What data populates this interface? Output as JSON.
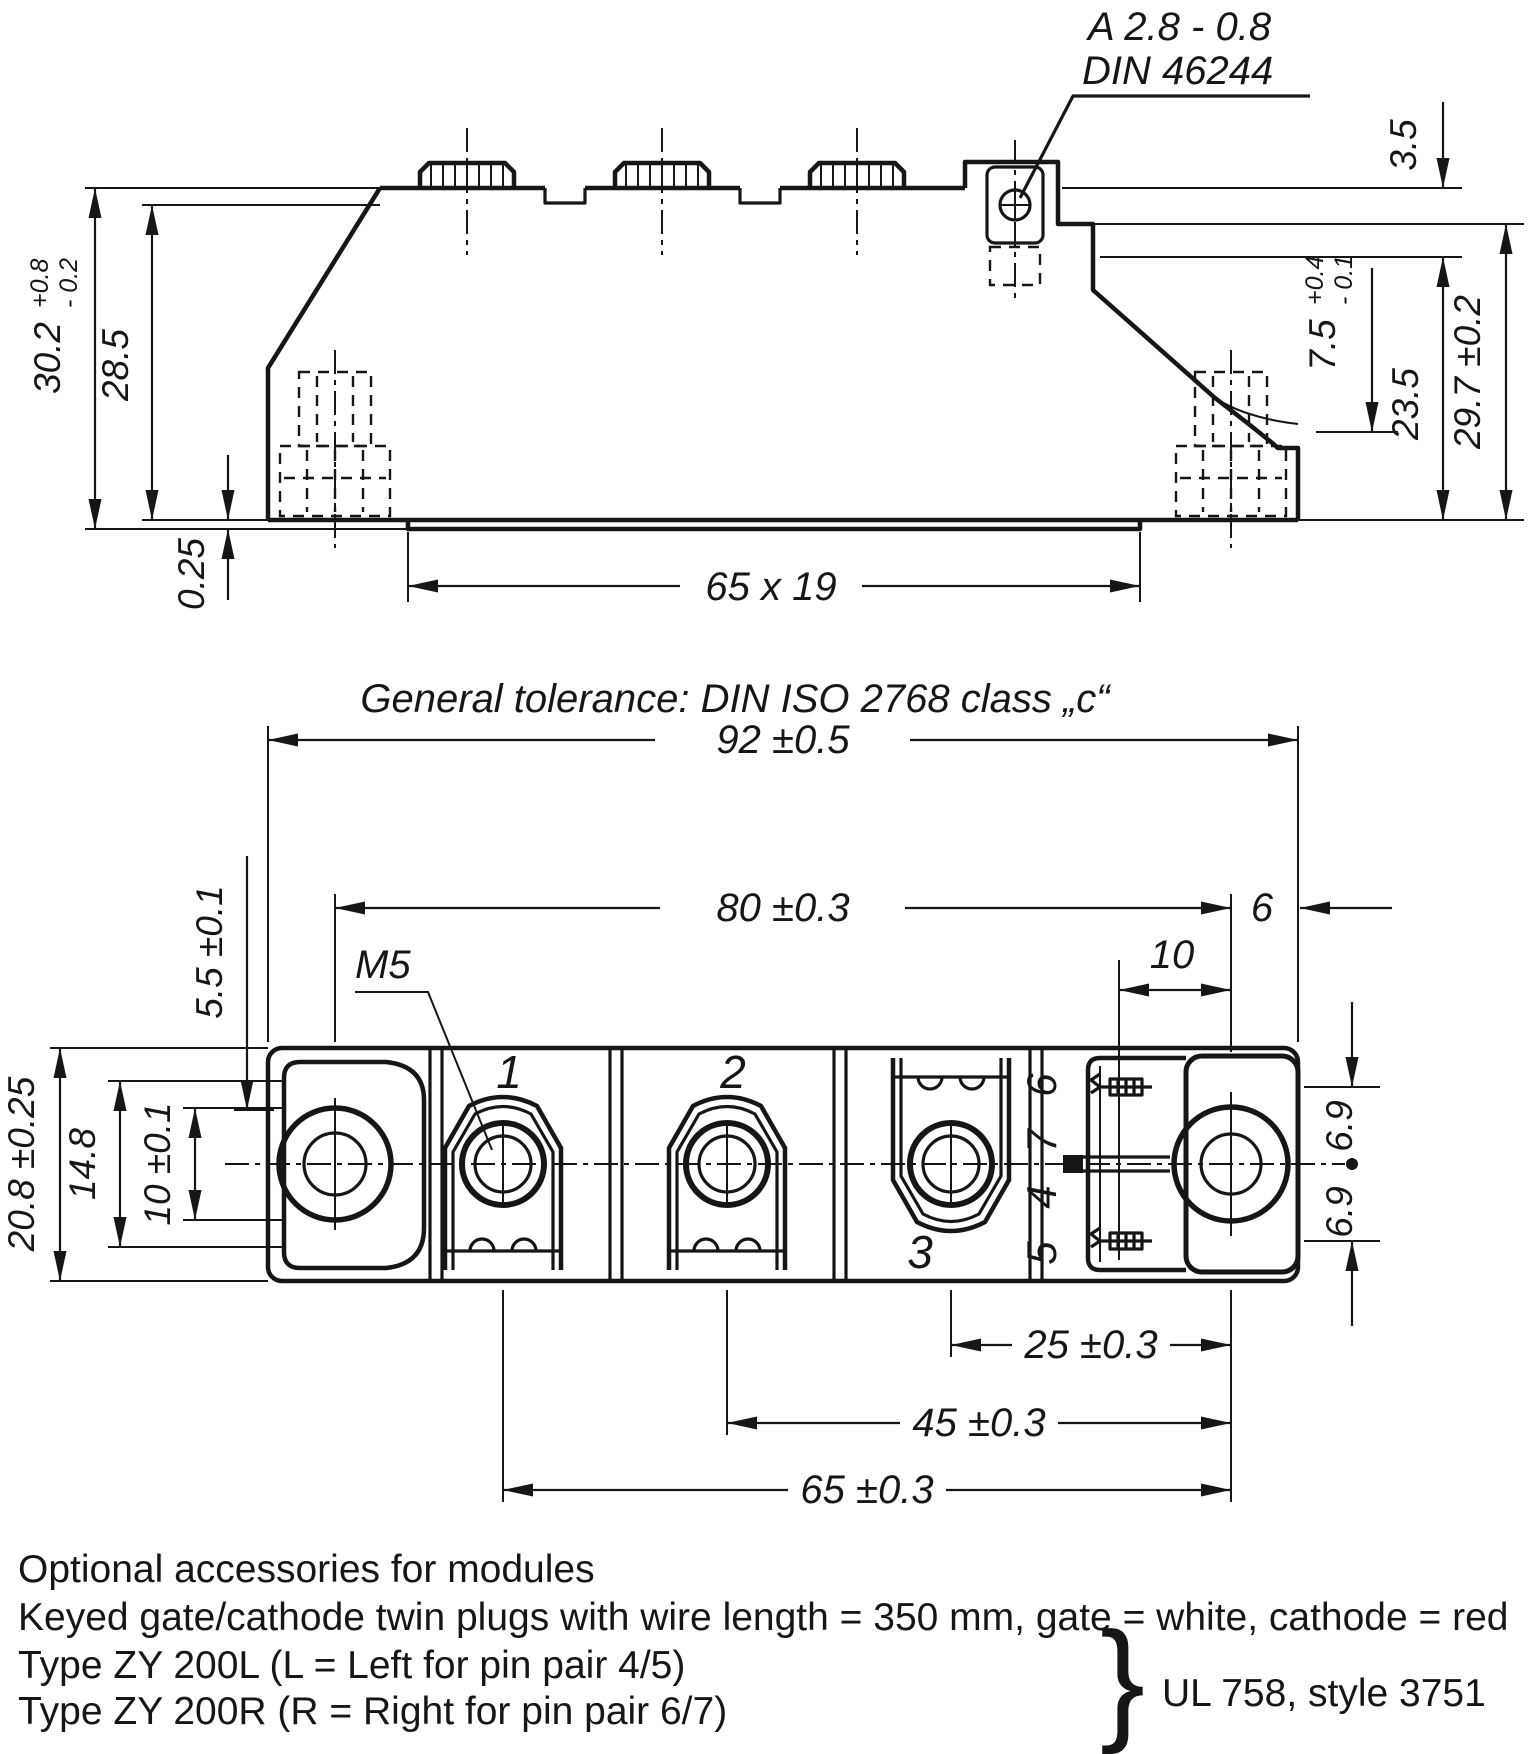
{
  "side_view": {
    "callout": {
      "line1": "A 2.8 - 0.8",
      "line2": "DIN 46244"
    },
    "height_overall": {
      "main": "30.2",
      "tol_plus": "+0.8",
      "tol_minus": "- 0.2"
    },
    "height_inner": "28.5",
    "baseplate_step": "0.25",
    "base_area": "65 x 19",
    "tab_offset": "3.5",
    "recess_depth": {
      "main": "7.5",
      "tol_plus": "+0.4",
      "tol_minus": "- 0.1"
    },
    "ledge_height": "23.5",
    "height_total": "29.7 ±0.2"
  },
  "tolerance_note": "General tolerance: DIN ISO 2768 class „c“",
  "plan_view": {
    "width_overall": "92 ±0.5",
    "hole_spacing": "80 ±0.3",
    "hole_edge": "6",
    "pin_offset": "10",
    "pin_row": "5.5 ±0.1",
    "slot_len": "14.8",
    "slot_width": "10 ±0.1",
    "depth_overall": "20.8 ±0.25",
    "thread": "M5",
    "terminal_1": "1",
    "terminal_2": "2",
    "terminal_3": "3",
    "pin_6": "6",
    "pin_7": "7",
    "pin_4": "4",
    "pin_5": "5",
    "pin_up": "6.9",
    "pin_down": "6.9",
    "pitch_25": "25 ±0.3",
    "pitch_45": "45 ±0.3",
    "pitch_65": "65 ±0.3"
  },
  "notes": {
    "line1": "Optional accessories for modules",
    "line2": "Keyed gate/cathode twin plugs with wire length = 350 mm, gate = white, cathode = red",
    "line3": "Type ZY 200L  (L = Left for pin pair 4/5)",
    "line4": "Type ZY 200R (R = Right for pin pair 6/7)",
    "brace": "}",
    "ul_note": "UL 758, style 3751"
  }
}
